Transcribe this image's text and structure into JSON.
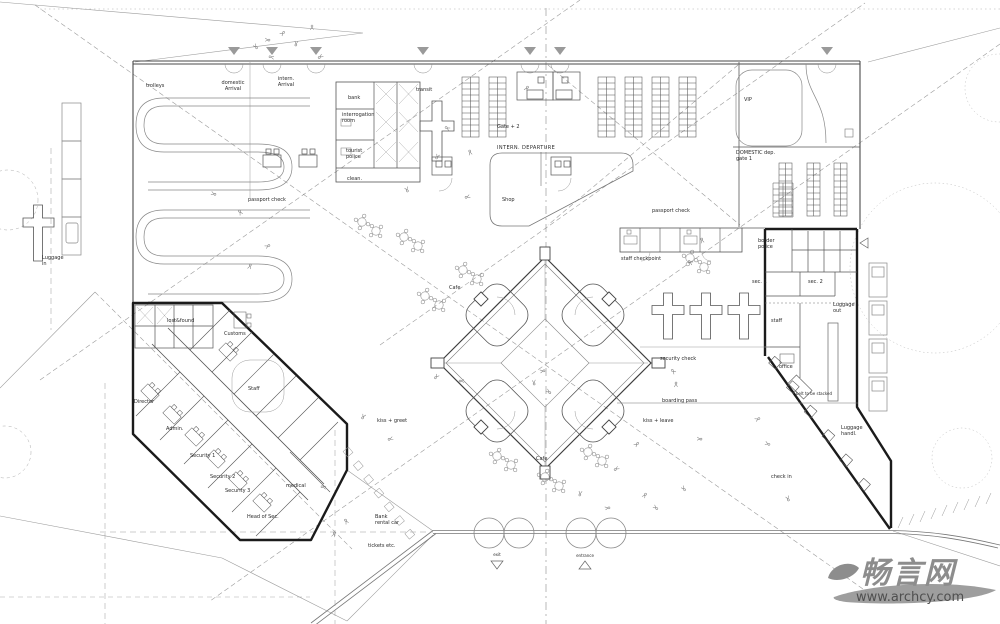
{
  "labels": {
    "trolleys": "trolleys",
    "domestic_arrival": "domestic\nArrival",
    "intern_arrival": "intern.\nArrival",
    "bank": "bank",
    "interrogation_room": "interrogation\nroom",
    "tourist_police": "tourist\npolice",
    "clean": "clean.",
    "transit": "transit",
    "passport_check_left": "passport check",
    "gate_plus_2": "Gate + 2",
    "intern_departure": "INTERN. DEPARTURE",
    "shop": "Shop",
    "passport_check_right": "passport check",
    "staff_checkpoint": "staff checkpoint",
    "vip": "VIP",
    "domestic_dep_gate1": "DOMESTIC dep.\ngate 1",
    "border_police": "border\npolice",
    "sec_1": "sec. 1",
    "sec_2": "sec. 2",
    "staff_right": "staff",
    "luggage_out": "Luggage\nout",
    "office": "office",
    "belt_stacked": "belt to be stacked",
    "luggage_handl": "Luggage\nhandl.",
    "check_in": "check in",
    "security_check": "security check",
    "boarding_pass": "boarding pass",
    "kiss_leave": "kiss + leave",
    "kiss_greet": "kiss + greet",
    "cafe_upper": "Cafe",
    "cafe_lower": "Cafe",
    "exit": "exit",
    "entrance": "entrance",
    "bank_rental_car": "Bank\nrental car",
    "tickets_etc": "tickets etc.",
    "lost_found": "lost&found",
    "customs": "Customs",
    "staff_left": "Staff",
    "director": "Director",
    "admin": "Admin.",
    "security_1": "Security 1",
    "security_2": "Security 2",
    "security_3": "Security 3",
    "head_of_sec": "Head of Sec.",
    "medical": "medical",
    "luggage_in": "Luggage\nin"
  },
  "watermark": {
    "logo_text": "畅言网",
    "url": "www.archcy.com",
    "color": "#8d8d8d"
  },
  "colors": {
    "paper": "#ffffff",
    "thick_wall": "#1b1b1b",
    "wall": "#4a4a4a",
    "line": "#555555",
    "light_line": "#999999",
    "label": "#2a2a2a"
  }
}
